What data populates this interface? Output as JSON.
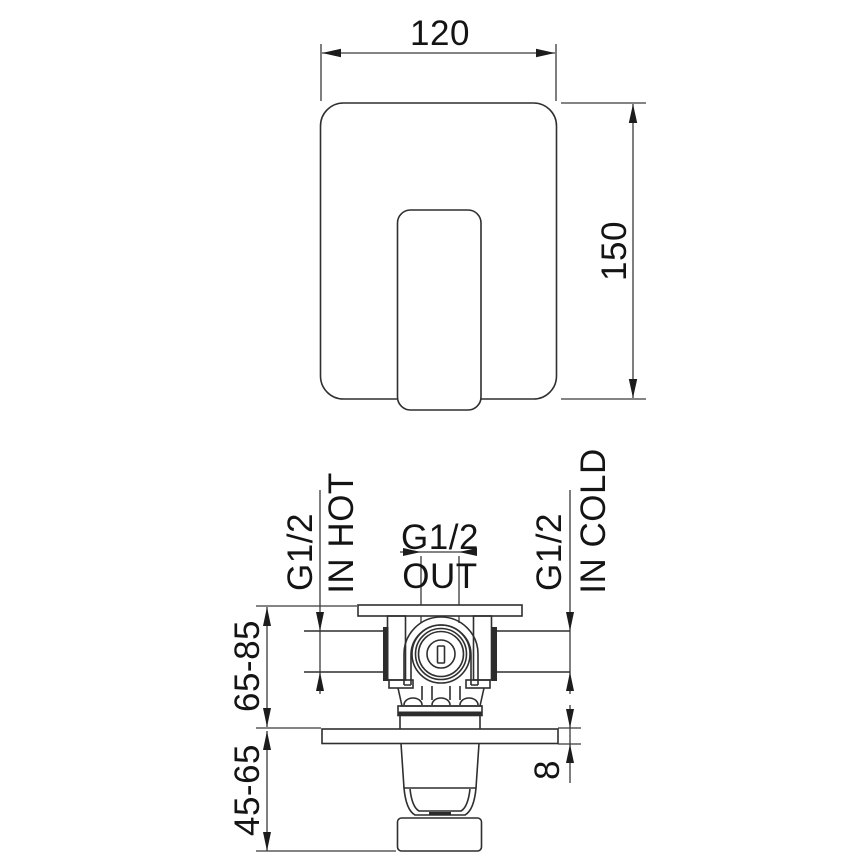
{
  "drawing": {
    "type": "technical-dimension-drawing",
    "background_color": "#ffffff",
    "line_color": "#2f2f2f",
    "text_color": "#141414",
    "top_view": {
      "width_dim": "120",
      "height_dim": "150"
    },
    "front_view": {
      "hot_inlet": {
        "thread": "G1/2",
        "label": "IN HOT"
      },
      "outlet": {
        "thread": "G1/2",
        "label": "OUT"
      },
      "cold_inlet": {
        "thread": "G1/2",
        "label": "IN COLD"
      },
      "install_depth_dim": "65-85",
      "handle_projection_dim": "45-65",
      "plate_thickness_dim": "8"
    }
  }
}
